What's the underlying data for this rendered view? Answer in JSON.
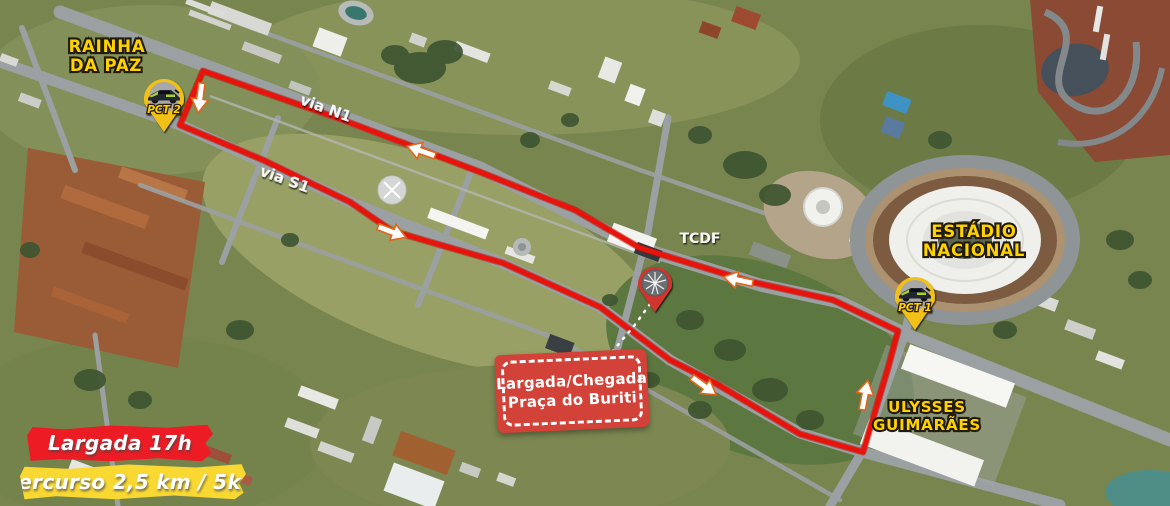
{
  "map": {
    "colors": {
      "route_red": "#e8140c",
      "banner_red": "#ed1c24",
      "banner_yellow": "#f9d832",
      "badge_red": "#d24238",
      "pin_yellow": "#f2c117",
      "pin_red": "#d1342d",
      "label_yellow": "#ffd200",
      "label_white": "#ffffff"
    },
    "place_labels": {
      "rainha": {
        "line1": "RAINHA",
        "line2": "DA PAZ"
      },
      "estadio": {
        "line1": "ESTÁDIO",
        "line2": "NACIONAL"
      },
      "ulysses": {
        "line1": "ULYSSES",
        "line2": "GUIMARÃES"
      },
      "tcdf": "TCDF",
      "via_n1": "via N1",
      "via_s1": "via S1"
    },
    "markers": {
      "pct2": {
        "label": "PCT 2",
        "transform": "translate(164,99)"
      },
      "pct1": {
        "label": "PCT 1",
        "transform": "translate(915,297)"
      },
      "start_finish_pin": {
        "transform": "translate(655,284)"
      }
    },
    "route": {
      "points": "203,71 340,119 480,172 575,210 640,248 748,281 833,300 898,331 888,368 863,452 800,434 717,384 670,360 600,307 503,263 392,231 350,202 263,160 180,125",
      "connector_points": "650,304 634,326 612,352",
      "arrows": [
        {
          "transform": "translate(200,98) rotate(97)"
        },
        {
          "transform": "translate(421,151) rotate(199)"
        },
        {
          "transform": "translate(392,232) rotate(21)"
        },
        {
          "transform": "translate(738,280) rotate(192)"
        },
        {
          "transform": "translate(704,386) rotate(36)"
        },
        {
          "transform": "translate(865,395) rotate(-79)"
        }
      ]
    },
    "start_finish_badge": {
      "line1": "Largada/Chegada",
      "line2": "Praça do Buriti"
    },
    "banners": {
      "start_time": "Largada 17h",
      "course": "Percurso 2,5 km / 5km"
    }
  }
}
